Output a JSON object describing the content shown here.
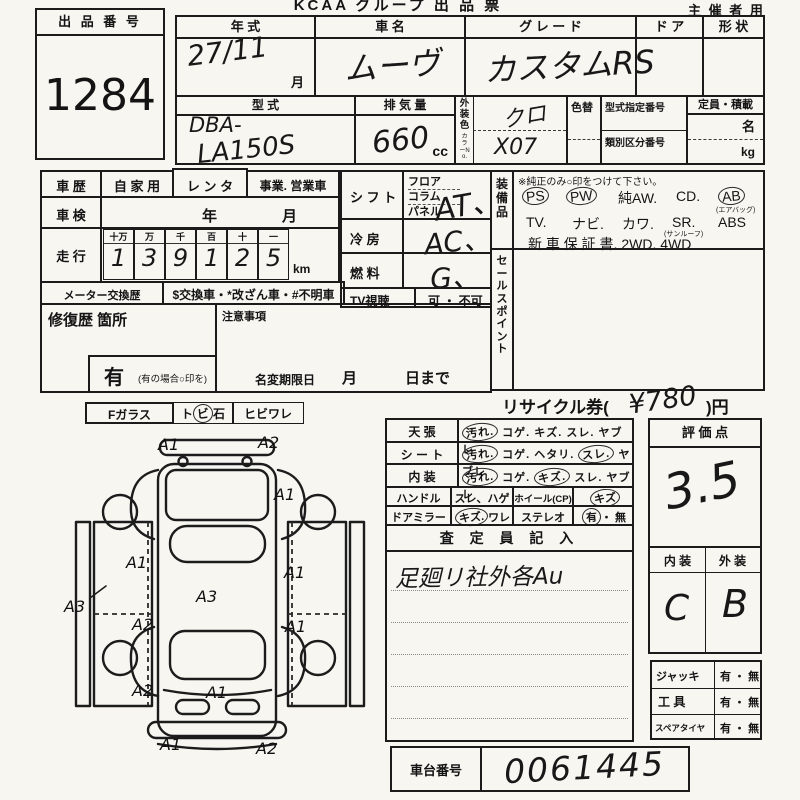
{
  "header": {
    "title": "KCAA グループ 出 品 票",
    "audience": "主 催 者 用",
    "lot_label": "出 品 番 号",
    "lot_number": "1284"
  },
  "vehicle": {
    "year_label": "年    式",
    "year_value": "27/11",
    "month_suffix": "月",
    "name_label": "車    名",
    "name_value": "ムーヴ",
    "grade_label": "グ レ ー ド",
    "grade_value": "カスタムRS",
    "door_label": "ド  ア",
    "shape_label": "形  状",
    "model_label": "型    式",
    "model_value1": "DBA-",
    "model_value2": "LA150S",
    "disp_label": "排 気 量",
    "disp_value": "660",
    "disp_unit": "cc",
    "color_label": "外装色",
    "color_no_label": "カラーNo.",
    "color_value": "クロ",
    "color_no_value": "X07",
    "color_change_label": "色替",
    "type_no_label": "型式指定番号",
    "class_no_label": "類別区分番号",
    "capacity_label": "定員・積載",
    "capacity_persons": "名",
    "capacity_kg": "kg"
  },
  "history": {
    "label": "車  歴",
    "opt_private": "自 家 用",
    "opt_rental": "レ ン タ",
    "opt_business": "事業. 営業車",
    "inspection_label": "車  検",
    "inspection_year": "年",
    "inspection_month": "月",
    "mileage_label": "走  行",
    "mileage_cols": [
      "十万",
      "万",
      "千",
      "百",
      "十",
      "一"
    ],
    "mileage_digits": [
      "1",
      "3",
      "9",
      "1",
      "2",
      "5"
    ],
    "mileage_unit": "km",
    "meter_label": "メーター交換歴",
    "meter_text": "$交換車・*改ざん車・#不明車",
    "repair_label": "修復歴  箇所",
    "caution_label": "注意事項",
    "repair_has": "有",
    "repair_note": "(有の場合○印を)",
    "rename_label": "名変期限日",
    "rename_month": "月",
    "rename_day": "日まで"
  },
  "spec": {
    "shift_label": "シ フ ト",
    "shift_opts": [
      "フロア",
      "コラム",
      "パネル"
    ],
    "shift_value": "AT、",
    "ac_label": "冷    房",
    "ac_value": "AC、",
    "fuel_label": "燃    料",
    "fuel_value": "G、",
    "tv_label": "TV視聴",
    "tv_opts": "可 ・ 不可"
  },
  "equipment": {
    "label": "装備品",
    "note": "※純正のみ○印をつけて下さい。",
    "items1": [
      "PS",
      "PW",
      "純AW.",
      "CD.",
      "AB"
    ],
    "ab_note": "(エアバッグ)",
    "items2": [
      "TV.",
      "ナビ.",
      "カワ.",
      "SR.",
      "ABS"
    ],
    "sr_note": "(サンルーフ)",
    "line3": "新 車 保 証 書.   2WD.   4WD",
    "sales_label": "セールスポイント"
  },
  "recycle": {
    "prefix": "リサイクル券(",
    "amount": "¥780",
    "suffix": ")円"
  },
  "condition": {
    "rows": [
      {
        "label": "天    張",
        "opts": [
          "汚れ.",
          "コゲ.",
          "キズ.",
          "スレ.",
          "ヤブレ"
        ]
      },
      {
        "label": "シ ー ト",
        "opts": [
          "汚れ.",
          "コゲ.",
          "ヘタリ.",
          "スレ.",
          "ヤブレ"
        ]
      },
      {
        "label": "内    装",
        "opts": [
          "汚れ.",
          "コゲ.",
          "キズ.",
          "スレ.",
          "ヤブレ"
        ]
      }
    ],
    "handle_label": "ハンドル",
    "handle_opts": "スレ、ハゲ",
    "wheel_label": "ホイール(CP)",
    "wheel_value": "キズ",
    "mirror_label": "ドアミラー",
    "mirror_opts": [
      "キズ.",
      "ワレ"
    ],
    "stereo_label": "ステレオ",
    "stereo_opts": [
      "有",
      "・ 無"
    ],
    "inspector_label": "査  定  員  記  入",
    "inspector_note": "足廻リ社外各Au"
  },
  "rating": {
    "label": "評   価   点",
    "score": "3.5",
    "interior_label": "内  装",
    "exterior_label": "外  装",
    "interior_grade": "C",
    "exterior_grade": "B",
    "jack_label": "ジャッキ",
    "jack_opts": "有 ・ 無",
    "tool_label": "工    具",
    "tool_opts": "有 ・ 無",
    "spare_label": "スペアタイヤ",
    "spare_opts": "有 ・ 無"
  },
  "chassis": {
    "label": "車台番号",
    "value": "0061445"
  },
  "glass": {
    "label": "Fガラス",
    "chip_parts": [
      "ト",
      "ビ",
      "石"
    ],
    "crack": "ヒビワレ"
  },
  "diagram": {
    "marks": [
      "A1",
      "A2",
      "A1",
      "A1",
      "A3",
      "A1",
      "A3",
      "A2",
      "A1",
      "A2",
      "A1",
      "A1",
      "A2"
    ]
  }
}
